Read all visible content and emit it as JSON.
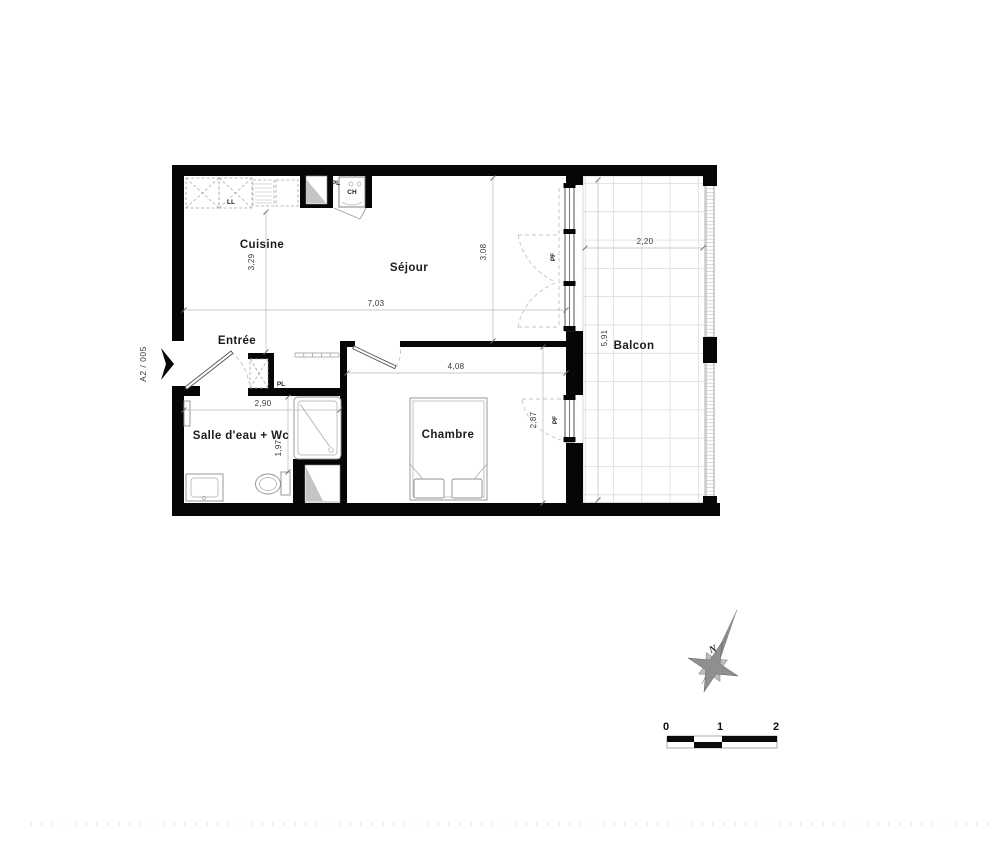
{
  "unit_label": "A2 / 005",
  "rooms": {
    "cuisine": "Cuisine",
    "sejour": "Séjour",
    "entree": "Entrée",
    "salle_eau": "Salle d'eau + Wc",
    "chambre": "Chambre",
    "balcon": "Balcon"
  },
  "fixtures": {
    "ll": "LL",
    "pl_kitchen": "PL",
    "ch": "CH",
    "pl_entree": "PL",
    "pf_sejour": "PF",
    "pf_chambre": "PF"
  },
  "dimensions": {
    "cuisine_depth": "3,29",
    "total_width": "7,03",
    "sejour_depth": "3,08",
    "balcon_width": "2,20",
    "balcon_depth": "5,91",
    "salle_eau_width": "2,90",
    "salle_eau_depth": "1,97",
    "chambre_width": "4,08",
    "chambre_depth": "2,87"
  },
  "compass": {
    "north": "N"
  },
  "scale_bar": {
    "tick_0": "0",
    "tick_1": "1",
    "tick_2": "2"
  },
  "colors": {
    "wall": "#060606",
    "dimension_text": "#3a3a3a",
    "fixture_line": "#8f8f8f",
    "tile_line": "#dcdcdc",
    "swing_line": "#c3c3c3"
  }
}
